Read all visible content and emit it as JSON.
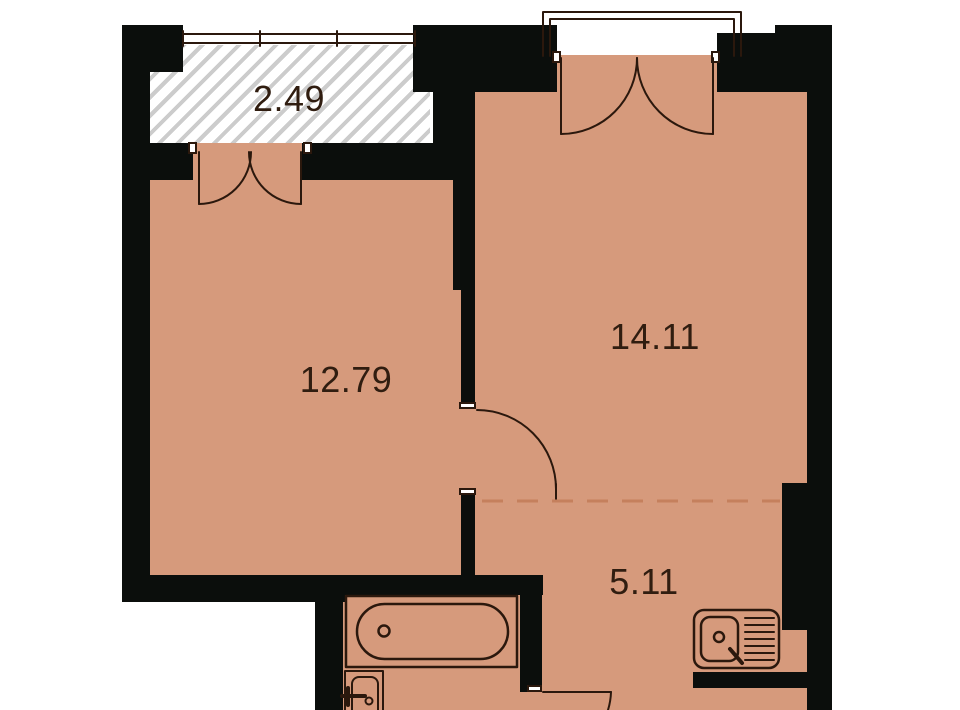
{
  "page": {
    "type": "apartment floor plan"
  },
  "rooms": [
    {
      "name": "balcony",
      "area_label": "2.49"
    },
    {
      "name": "room-left",
      "area_label": "12.79"
    },
    {
      "name": "room-right",
      "area_label": "14.11"
    },
    {
      "name": "hall-kitchen",
      "area_label": "5.11"
    }
  ],
  "fixtures": [
    "window-icon",
    "balcony-railing-icon",
    "balcony-door-swing-icon",
    "interior-door-swing-icon",
    "bathroom-door-swing-icon",
    "bathtub-icon",
    "washbasin-icon",
    "kitchen-sink-icon"
  ],
  "colors": {
    "floor": "#d69a7c",
    "wall": "#0b0e0c",
    "line": "#2b180d",
    "dash": "#c5805d",
    "hatch": "#cccccc",
    "text": "#301d10"
  }
}
